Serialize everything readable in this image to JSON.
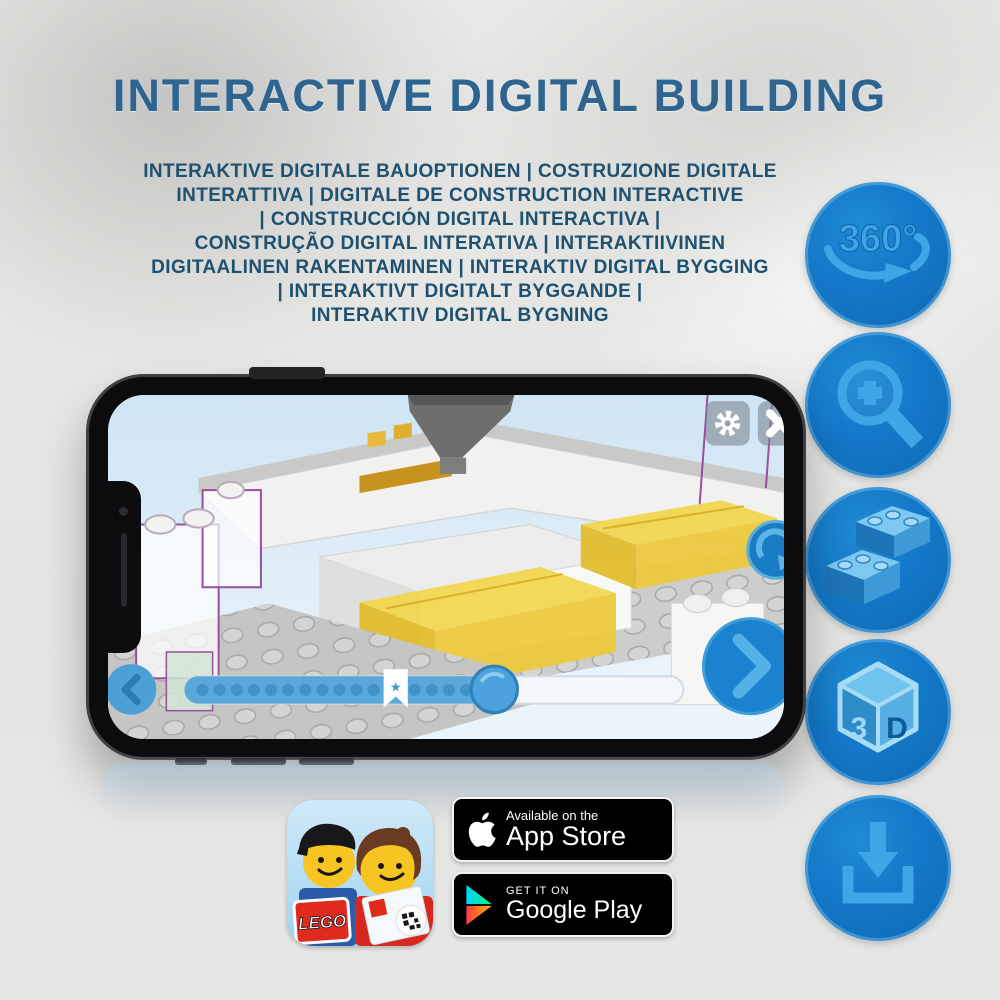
{
  "title": "INTERACTIVE DIGITAL BUILDING",
  "subtitle": {
    "lines": [
      "INTERAKTIVE DIGITALE BAUOPTIONEN | COSTRUZIONE DIGITALE",
      "INTERATTIVA | DIGITALE DE CONSTRUCTION INTERACTIVE",
      "| CONSTRUCCIÓN DIGITAL INTERACTIVA |",
      "CONSTRUÇÃO DIGITAL INTERATIVA | INTERAKTIIVINEN",
      "DIGITAALINEN RAKENTAMINEN | INTERAKTIV DIGITAL BYGGING",
      "| INTERAKTIVT DIGITALT BYGGANDE |",
      "INTERAKTIV DIGITAL BYGNING"
    ]
  },
  "features": {
    "rotation_label": "360°",
    "cube_left": "3",
    "cube_right": "D"
  },
  "phone": {
    "slider": {
      "star": "★"
    }
  },
  "app_icon": {
    "logo": "LEGO"
  },
  "badges": {
    "app_store": {
      "tagline": "Available on the",
      "store": "App Store"
    },
    "google_play": {
      "tagline": "GET IT ON",
      "store": "Google Play"
    }
  },
  "colors": {
    "title_blue": "#2d6490",
    "subtitle_blue": "#1e5070",
    "icon_circle_blue": "#1478c8",
    "icon_glyph_blue": "#3ea6e6",
    "badge_black": "#000000",
    "lego_yellow": "#f3d74e",
    "ghost_outline_purple": "#9a4f9f",
    "screen_sky_blue": "#d3e7f5"
  }
}
